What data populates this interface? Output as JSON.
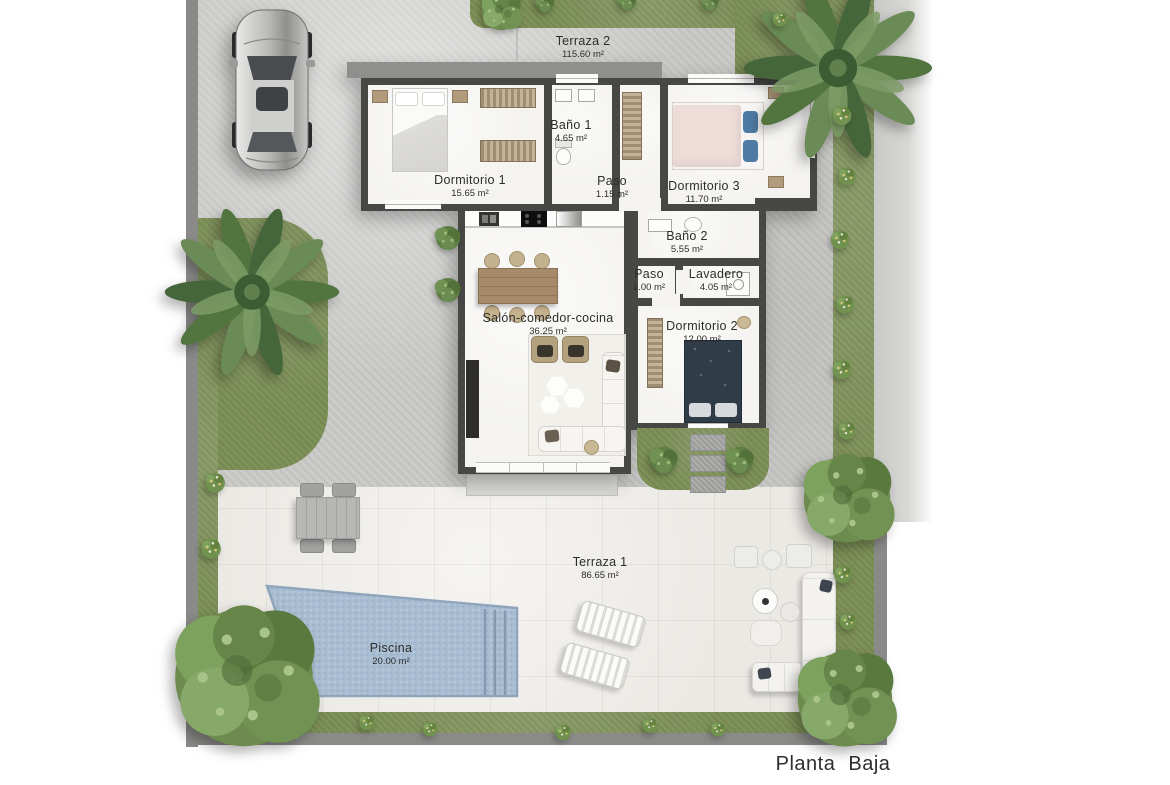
{
  "title": "Planta Baja",
  "rooms": {
    "terraza2": {
      "name": "Terraza 2",
      "area": "115.60 m²"
    },
    "dormitorio1": {
      "name": "Dormitorio 1",
      "area": "15.65 m²"
    },
    "bano1": {
      "name": "Baño 1",
      "area": "4.65 m²"
    },
    "paso1": {
      "name": "Paso",
      "area": "1.15 m²"
    },
    "dormitorio3": {
      "name": "Dormitorio 3",
      "area": "11.70 m²"
    },
    "bano2": {
      "name": "Baño 2",
      "area": "5.55 m²"
    },
    "paso2": {
      "name": "Paso",
      "area": "1.00 m²"
    },
    "lavadero": {
      "name": "Lavadero",
      "area": "4.05 m²"
    },
    "dormitorio2": {
      "name": "Dormitorio 2",
      "area": "12.00 m²"
    },
    "salon": {
      "name": "Salón-comedor-cocina",
      "area": "36.25 m²"
    },
    "terraza1": {
      "name": "Terraza 1",
      "area": "86.65 m²"
    },
    "piscina": {
      "name": "Piscina",
      "area": "20.00 m²"
    }
  },
  "colors": {
    "wall": "#474745",
    "grass": "#7e9158",
    "pool_water": "#a9bdd2",
    "concrete": "#c9c9c7",
    "paving": "#ebe9e4"
  }
}
